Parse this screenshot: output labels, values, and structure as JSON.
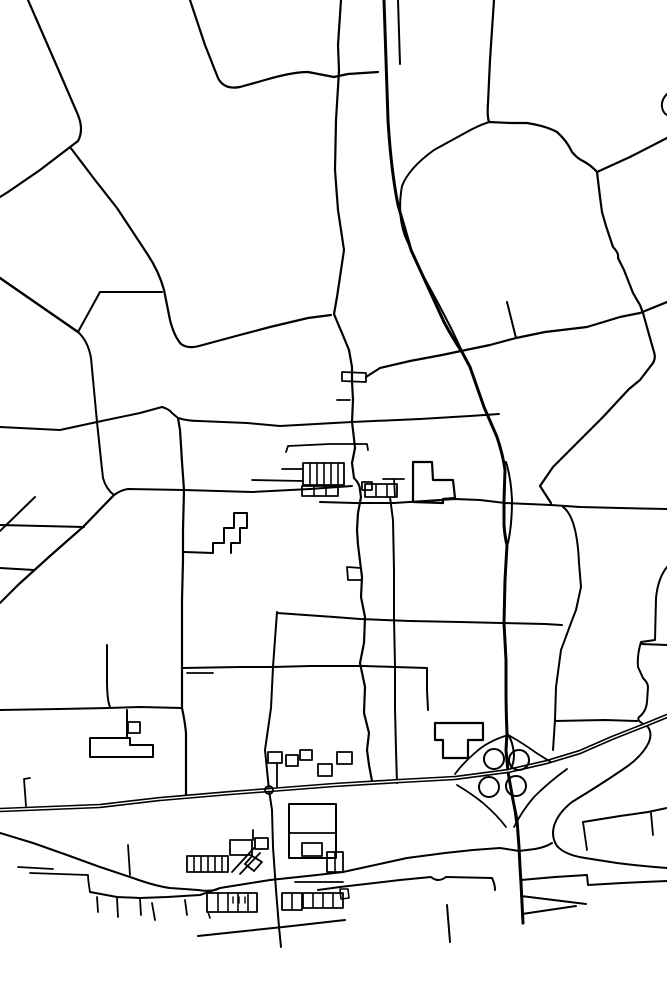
{
  "map": {
    "width": 667,
    "height": 1000,
    "background": "#ffffff",
    "stroke": "#000000",
    "default_width": 2,
    "paths": [
      {
        "name": "field-boundary-nw",
        "d": "M28,0 L62,78 L78,115 Q84,130 78,141 L40,170 L8,192 L0,197",
        "w": 2.2
      },
      {
        "name": "road-nw-to-town",
        "d": "M70,147 L95,180 L117,208 L146,252 Q159,271 164,290 L170,320 Q174,336 181,344 Q188,349 199,346 L236,336 L270,327 L308,318 L331,315",
        "w": 2.2
      },
      {
        "name": "link-road-292",
        "d": "M100,292 L162,292",
        "w": 2
      },
      {
        "name": "peak-link",
        "d": "M78,332 L100,292",
        "w": 2
      },
      {
        "name": "west-diagonal",
        "d": "M0,278 L78,332",
        "w": 2.4
      },
      {
        "name": "road-x97",
        "d": "M78,332 Q88,341 91,358 L97,422 L101,460 L103,478 Q106,489 114,495",
        "w": 2
      },
      {
        "name": "sw-diagonal",
        "d": "M114,495 L83,527 L50,556 L18,585 L0,603",
        "w": 2.2
      },
      {
        "name": "ew-road-490",
        "d": "M114,495 Q121,490 128,489 L184,490 L252,492 L310,489 L352,486",
        "w": 2
      },
      {
        "name": "parallel-480",
        "d": "M252,480 L303,481",
        "w": 1.8
      },
      {
        "name": "parallel-468",
        "d": "M282,469 L303,469",
        "w": 1.8
      },
      {
        "name": "ew-road-420",
        "d": "M0,427 L60,430 L97,422 L140,413 L162,407 Q169,409 172,413 L178,418 Q188,421 199,421 L247,423 L280,426 L352,422 L420,419 L470,416 L499,414",
        "w": 2
      },
      {
        "name": "town-main-street",
        "d": "M341,0 L338,45 L339,71 L336,120 L335,170 L338,210 L344,250 L337,297 L334,314 Q338,324 342,333 L349,350 L352,367 L352,381 L353,400 L352,422 Q354,438 355,448 L352,463 L354,478 Q360,484 360,490 L361,497 L358,513 L357,530 L358,545 L362,577 L361,597 L365,617 L364,643 L360,663 L365,687 L364,713 L369,733 L367,750 L369,765 L372,781",
        "w": 2.2
      },
      {
        "name": "street-jog-rect",
        "d": "M342,372 L366,373 L366,382 L342,381 Z",
        "w": 1.8
      },
      {
        "name": "side-tick-400",
        "d": "M337,400 L350,400",
        "w": 1.8
      },
      {
        "name": "ene-long-road",
        "d": "M366,377 L380,368 L410,361 L442,355 L461,351 L490,345 L516,338 L545,332 L587,327 L620,317 L640,313 L667,302",
        "w": 2.2
      },
      {
        "name": "spur-302",
        "d": "M507,302 L516,338",
        "w": 2
      },
      {
        "name": "street-x394",
        "d": "M390,497 L393,520 L394,570 L394,618 L395,666 L395,708 L396,750 L397,783",
        "w": 2
      },
      {
        "name": "ew-road-503",
        "d": "M320,502 L355,503 L394,503 L455,499 L480,500 L505,503 L551,505 L580,507 L620,508 L667,509",
        "w": 2
      },
      {
        "name": "ew-road-617",
        "d": "M334,617 L360,619 L410,621 L460,622 L501,623 L545,624 L562,625",
        "w": 2
      },
      {
        "name": "ew-road-666",
        "d": "M182,668 L240,667 L273,667 L310,666 L364,666 L395,667 L427,668 L427,690 L428,710",
        "w": 2
      },
      {
        "name": "tick-672",
        "d": "M187,673 L213,673",
        "w": 1.8
      },
      {
        "name": "main-ns-road",
        "d": "M178,418 L180,430 L182,462 L184,490 L183,530 L183,560 L182,600 L182,640 L182,668 L182,708 Q185,722 186,733 L186,760 L186,795",
        "w": 2.2
      },
      {
        "name": "ew-road-708",
        "d": "M0,710 L60,709 L108,708 L140,707 L182,708",
        "w": 2
      },
      {
        "name": "stub-x107",
        "d": "M107,645 L107,680 Q107,700 110,707",
        "w": 2
      },
      {
        "name": "road-x277",
        "d": "M277,612 L273,667 L271,708 L265,750 L267,770 L269,790 L272,810 L273,847 L276,890 L279,927 L281,947",
        "w": 2
      },
      {
        "name": "ew-road-613",
        "d": "M277,613 L334,617",
        "w": 2
      },
      {
        "name": "loop-rect-567",
        "d": "M361,568 L347,567 L348,580 L362,580",
        "w": 1.8
      },
      {
        "name": "field-a",
        "d": "M35,497 L0,531",
        "w": 2
      },
      {
        "name": "field-b",
        "d": "M0,525 L84,527",
        "w": 2
      },
      {
        "name": "field-c",
        "d": "M0,568 L34,570",
        "w": 2
      },
      {
        "name": "north-stub-399",
        "d": "M398,0 L400,64",
        "w": 2
      },
      {
        "name": "top-arc-road",
        "d": "M190,0 L205,45 L218,78 Q224,90 240,87 L265,80 Q292,72 308,72 L334,77 L348,74 L378,72",
        "w": 2.2
      },
      {
        "name": "north-approach",
        "d": "M494,0 L490,60 L488,103 Q487,116 489,122",
        "w": 2.2
      },
      {
        "name": "j2-west-curve",
        "d": "M489,122 Q477,126 465,133 L434,150 Q409,168 402,186 Q397,214 405,236 L420,270 L438,303 L452,330 L461,349",
        "w": 2
      },
      {
        "name": "j2-east-curve",
        "d": "M489,122 L510,123 L527,123 Q546,126 557,132 Q567,141 572,152 Q578,159 583,161 Q592,166 597,172",
        "w": 2.2
      },
      {
        "name": "j2-ne-road",
        "d": "M597,172 L630,157 L667,138",
        "w": 2.2
      },
      {
        "name": "j2-south-road",
        "d": "M597,172 L600,197 L602,212 L606,226 L613,247 Q619,253 618,258 L624,270 L633,293 L640,305 L643,313 L650,338 L654,352 Q656,358 653,363 L640,380 L629,389 L603,417 L577,443 L553,467 L540,486 L551,503",
        "w": 2.2
      },
      {
        "name": "right-edge-arc",
        "d": "M667,94 Q661,100 662,107 Q663,113 667,115",
        "w": 2
      },
      {
        "name": "road-v2",
        "d": "M563,507 Q577,517 579,563 L581,587 L576,610 L571,623 L561,650 L556,687 L555,720 L553,750",
        "w": 2
      },
      {
        "name": "link-721",
        "d": "M555,721 L605,720 L637,721",
        "w": 2
      },
      {
        "name": "road-r1-east",
        "d": "M667,567 Q658,578 656,598 L655,640 L641,642 Q637,655 638,667 L643,678 Q648,683 648,687 L647,702 Q646,712 639,717 Q636,721 646,725 Q653,731 649,742 Q642,757 622,770 Q600,785 572,802 Q558,813 554,826 Q551,837 557,846 Q565,855 585,858 L617,863 Q640,866 667,868",
        "w": 2
      },
      {
        "name": "branch-645",
        "d": "M641,644 L667,645",
        "w": 2
      },
      {
        "name": "h1-road",
        "d": "M583,822 L620,816 L648,812 L667,808",
        "w": 2
      },
      {
        "name": "h1-tick",
        "d": "M651,813 L653,835",
        "w": 1.8
      },
      {
        "name": "h1-link",
        "d": "M583,822 L587,850",
        "w": 1.8
      },
      {
        "name": "h2-road",
        "d": "M521,880 L555,877 L587,875 L588,885 L622,883 L667,881",
        "w": 2
      },
      {
        "name": "h3a-road",
        "d": "M521,896 L586,904",
        "w": 2
      },
      {
        "name": "h3b-road",
        "d": "M522,914 L576,906",
        "w": 2
      },
      {
        "name": "lone-stub",
        "d": "M447,905 L450,942",
        "w": 2
      },
      {
        "name": "west-curve",
        "d": "M0,833 L33,843 L67,855 L100,867 L133,878 Q155,886 170,888 L198,890 Q210,892 218,889",
        "w": 2
      },
      {
        "name": "village-street",
        "d": "M90,892 L117,897 L140,898 L167,897 L200,895 L220,888 L270,880 L317,875 L343,872 L375,865 L407,858 L445,853 L473,850 L500,848 L519,851 L535,849 Q546,847 552,843",
        "w": 2
      },
      {
        "name": "street-west-tail",
        "d": "M90,892 Q88,880 88,875 L30,873",
        "w": 1.8
      },
      {
        "name": "segment-867",
        "d": "M18,867 L53,869",
        "w": 1.8
      },
      {
        "name": "driveway-1",
        "d": "M97,897 L98,912",
        "w": 1.8
      },
      {
        "name": "driveway-2",
        "d": "M117,898 L118,917",
        "w": 1.8
      },
      {
        "name": "driveway-3",
        "d": "M140,899 L141,915",
        "w": 1.8
      },
      {
        "name": "driveway-4",
        "d": "M152,903 L155,920",
        "w": 1.8
      },
      {
        "name": "driveway-5",
        "d": "M185,900 L187,915",
        "w": 1.8
      },
      {
        "name": "tick-128",
        "d": "M128,845 L130,875",
        "w": 1.8
      },
      {
        "name": "hook-24",
        "d": "M30,778 L24,779 L26,806",
        "w": 1.8
      },
      {
        "name": "south-diagonal",
        "d": "M198,936 L245,931 L283,927 L345,920",
        "w": 2
      },
      {
        "name": "village-lower-road",
        "d": "M318,890 L340,887 L400,880 L431,877 Q438,883 446,877 L492,878 Q495,884 495,890",
        "w": 2
      },
      {
        "name": "lower-rect",
        "d": "M340,889 L341,899 L349,898 L348,889 Z",
        "w": 1.6
      },
      {
        "name": "ns-stub-816",
        "d": "M513,798 L516,822",
        "w": 1.8
      },
      {
        "name": "motorway-ns",
        "d": "M384,0 L386,60 L388,120 Q391,170 398,205 L411,250 L444,322 Q452,337 462,352 L470,367 L484,407 L497,437 Q503,455 505,470 L504,500 L504,525 Q505,538 507,545 L505,580 L504,623 L506,660 L506,687 Q506,712 507,733 L506,750 L508,772 L513,800 L517,820 L519,847 L520,867 L521,883 L523,923",
        "w": 3
      },
      {
        "name": "ns-fork-top",
        "d": "M506,462 Q511,478 512,500 Q512,525 508,543",
        "w": 2
      },
      {
        "name": "ns-fork-bottom",
        "d": "M507,733 Q513,741 514,755 Q514,763 511,768",
        "w": 2
      },
      {
        "name": "motorway-ew",
        "d": "M0,810 L50,808 L100,806 L160,799 L230,793 L270,790 L334,785 L400,781 L455,778 L508,771 L547,762 L580,752 L612,738 L645,725 L667,716",
        "w": 4.6,
        "casing": true
      },
      {
        "name": "ramp-nw",
        "d": "M505,736 Q487,742 476,752 Q463,763 455,774",
        "w": 1.8
      },
      {
        "name": "ramp-sw",
        "d": "M457,785 Q472,794 483,803 Q497,815 506,827",
        "w": 1.8
      },
      {
        "name": "ramp-ne",
        "d": "M510,736 Q524,744 535,752 Q544,758 551,762",
        "w": 1.8
      },
      {
        "name": "ramp-se",
        "d": "M514,827 Q522,811 534,797 Q549,782 567,769",
        "w": 1.8
      },
      {
        "name": "building-stepped-north",
        "d": "M184,552 L213,553 L213,543 L224,543 L224,528 L234,528 L234,513 L247,513 L247,528 L240,528 L240,543 L231,543 L231,553",
        "w": 2
      },
      {
        "name": "building-terrace",
        "d": "M303,463 L344,463 L344,485 L303,485 Z",
        "w": 1.8
      },
      {
        "name": "terrace-div-1",
        "d": "M310,463 L310,485",
        "w": 1.6
      },
      {
        "name": "terrace-div-2",
        "d": "M317,463 L317,485",
        "w": 1.6
      },
      {
        "name": "terrace-div-3",
        "d": "M324,463 L324,485",
        "w": 1.6
      },
      {
        "name": "terrace-div-4",
        "d": "M331,463 L331,485",
        "w": 1.6
      },
      {
        "name": "terrace-div-5",
        "d": "M338,463 L338,485",
        "w": 1.6
      },
      {
        "name": "building-row2",
        "d": "M302,486 L338,486 L338,496 L302,496 Z",
        "w": 1.8
      },
      {
        "name": "row2-div-1",
        "d": "M314,486 L314,496",
        "w": 1.6
      },
      {
        "name": "row2-div-2",
        "d": "M326,486 L326,496",
        "w": 1.6
      },
      {
        "name": "building-square",
        "d": "M362,482 L372,482 L372,490 L362,490 Z",
        "w": 1.8
      },
      {
        "name": "building-midblock",
        "d": "M365,484 L397,484 L397,497 L365,497 Z",
        "w": 1.8
      },
      {
        "name": "midblock-div-1",
        "d": "M376,484 L376,497",
        "w": 1.6
      },
      {
        "name": "midblock-div-2",
        "d": "M387,484 L387,497",
        "w": 1.6
      },
      {
        "name": "t-lane",
        "d": "M383,479 L404,479 M394,479 L395,497",
        "w": 1.8
      },
      {
        "name": "building-large-east",
        "d": "M413,482 L413,462 L432,462 L433,480 L453,480 L455,498 L443,499 L443,503 L413,502 Z",
        "w": 2.2
      },
      {
        "name": "street-445",
        "d": "M286,452 L288,446 L330,444 L367,444 L368,450",
        "w": 1.8
      },
      {
        "name": "building-t-shape",
        "d": "M435,723 L483,723 L483,740 L468,740 L468,758 L443,758 L443,740 L435,740 Z",
        "w": 2.2
      },
      {
        "name": "building-town-south",
        "d": "M127,710 L127,738 M90,738 L130,738 L130,745 L153,745 L153,757 L90,757 Z",
        "w": 2
      },
      {
        "name": "building-small-722",
        "d": "M128,722 L140,722 L140,733 L128,733 Z",
        "w": 1.8
      },
      {
        "name": "building-big-north",
        "d": "M289,804 L336,804 L336,858 L289,858 Z",
        "w": 2
      },
      {
        "name": "big-north-div",
        "d": "M289,833 L336,833",
        "w": 1.8
      },
      {
        "name": "big-north-inner",
        "d": "M302,843 L322,843 L322,856 L302,856 Z",
        "w": 1.8
      },
      {
        "name": "building-r-rect",
        "d": "M327,852 L343,852 L343,872 L327,872 Z",
        "w": 1.8
      },
      {
        "name": "r-rect-div",
        "d": "M335,852 L335,872",
        "w": 1.6
      },
      {
        "name": "cluster-rect-1",
        "d": "M230,840 L252,840 L252,855 L230,855 Z",
        "w": 1.8
      },
      {
        "name": "cluster-rect-2",
        "d": "M255,838 L268,838 L268,849 L255,849 Z",
        "w": 1.8
      },
      {
        "name": "cluster-diag-1",
        "d": "M232,872 L254,848",
        "w": 1.8
      },
      {
        "name": "cluster-diag-2",
        "d": "M240,874 L260,853",
        "w": 1.8
      },
      {
        "name": "cluster-diamond",
        "d": "M252,856 L262,862 L254,871 L245,864 Z",
        "w": 1.8
      },
      {
        "name": "cluster-stem",
        "d": "M253,830 L253,840",
        "w": 1.8
      },
      {
        "name": "building-west-row",
        "d": "M187,856 L228,856 L228,872 L187,872 Z",
        "w": 1.8
      },
      {
        "name": "west-row-div-1",
        "d": "M194,856 L194,872",
        "w": 1.6
      },
      {
        "name": "west-row-div-2",
        "d": "M201,856 L201,872",
        "w": 1.6
      },
      {
        "name": "west-row-div-3",
        "d": "M208,856 L208,872",
        "w": 1.6
      },
      {
        "name": "west-row-div-4",
        "d": "M215,856 L215,872",
        "w": 1.6
      },
      {
        "name": "west-row-div-5",
        "d": "M222,856 L222,872",
        "w": 1.6
      },
      {
        "name": "building-below-row",
        "d": "M207,893 L257,893 L257,912 L207,912 Z",
        "w": 1.8
      },
      {
        "name": "below-row-div-1",
        "d": "M218,893 L218,912",
        "w": 1.6
      },
      {
        "name": "below-row-div-2",
        "d": "M228,893 L228,912",
        "w": 1.6
      },
      {
        "name": "below-row-div-3",
        "d": "M238,893 L238,912",
        "w": 1.6
      },
      {
        "name": "below-row-div-4",
        "d": "M248,893 L248,912",
        "w": 1.6
      },
      {
        "name": "below-row-comb",
        "d": "M233,897 L233,903 M239,897 L239,903 M245,897 L245,903",
        "w": 1.4
      },
      {
        "name": "below-row-hook",
        "d": "M208,912 L210,918",
        "w": 1.6
      },
      {
        "name": "se-rect-1",
        "d": "M282,893 L302,893 L302,910 L282,910 Z",
        "w": 1.8
      },
      {
        "name": "se-rect-1-div",
        "d": "M292,893 L292,910",
        "w": 1.6
      },
      {
        "name": "se-rect-2",
        "d": "M303,893 L343,893 L343,908 L303,908 Z",
        "w": 1.8
      },
      {
        "name": "se-rect-2-div-1",
        "d": "M313,893 L313,908",
        "w": 1.6
      },
      {
        "name": "se-rect-2-div-2",
        "d": "M323,893 L323,908",
        "w": 1.6
      },
      {
        "name": "se-rect-2-div-3",
        "d": "M333,893 L333,908",
        "w": 1.6
      },
      {
        "name": "se-topline",
        "d": "M295,882 L343,882",
        "w": 1.8
      },
      {
        "name": "hwy-cluster-1",
        "d": "M268,752 L282,752 L282,763 L268,763 Z",
        "w": 1.8
      },
      {
        "name": "hwy-cluster-2",
        "d": "M286,755 L298,755 L298,766 L286,766 Z",
        "w": 1.8
      },
      {
        "name": "hwy-cluster-3",
        "d": "M300,750 L312,750 L312,760 L300,760 Z",
        "w": 1.8
      },
      {
        "name": "hwy-cluster-stem",
        "d": "M277,763 L277,787",
        "w": 1.8
      },
      {
        "name": "hwy-cluster-4",
        "d": "M318,764 L332,764 L332,776 L318,776 Z",
        "w": 1.8
      },
      {
        "name": "hwy-cluster-5",
        "d": "M337,752 L352,752 L352,764 L337,764 Z",
        "w": 1.8
      }
    ],
    "circles": [
      {
        "name": "clover-loop-nw",
        "cx": 494,
        "cy": 759,
        "r": 10,
        "w": 2
      },
      {
        "name": "clover-loop-ne",
        "cx": 519,
        "cy": 760,
        "r": 10,
        "w": 2
      },
      {
        "name": "clover-loop-sw",
        "cx": 489,
        "cy": 787,
        "r": 10,
        "w": 2
      },
      {
        "name": "clover-loop-se",
        "cx": 516,
        "cy": 786,
        "r": 10,
        "w": 2
      },
      {
        "name": "junction-circle",
        "cx": 269,
        "cy": 790,
        "r": 4,
        "w": 1.8
      }
    ]
  }
}
